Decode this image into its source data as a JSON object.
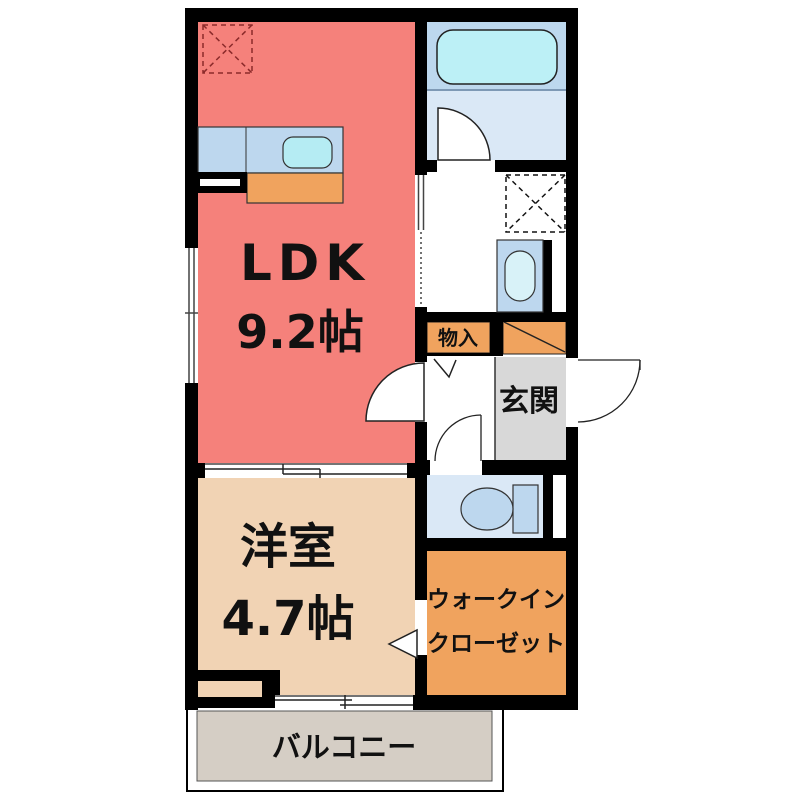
{
  "plan": {
    "type": "apartment-floor-plan",
    "rooms": {
      "ldk": {
        "label": "LDK",
        "size": "9.2帖"
      },
      "western_room": {
        "label": "洋室",
        "size": "4.7帖"
      },
      "entrance": {
        "label": "玄関"
      },
      "storage": {
        "label": "物入"
      },
      "walk_in_closet": {
        "label_line1": "ウォークイン",
        "label_line2": "クローゼット"
      },
      "balcony": {
        "label": "バルコニー"
      }
    },
    "fixtures": {
      "bathtub": "bathtub-icon",
      "toilet": "toilet-icon",
      "kitchen_sink": "kitchen-counter-sink-icon",
      "wash_basin": "wash-basin-icon",
      "washing_machine_space": "washing-machine-dashed-box-icon",
      "refrigerator_space": "refrigerator-dashed-box-icon",
      "shoe_cabinet": "shoe-cabinet-diagonal-icon"
    },
    "colors": {
      "wall": "#000000",
      "ldk": "#F5817B",
      "western": "#F1D3B4",
      "orange": "#F0A35E",
      "entrance_floor": "#D8D8D8",
      "balcony_floor": "#D5CEC5",
      "bath_floor": "#DAE8F6",
      "bath_tub_zone": "#BDD8EE",
      "tub": "#BCF0F6",
      "counter": "#BDD7EE",
      "sink": "#B5ECF3",
      "fixture": "#BDD7EE",
      "basin": "#D8F2F8",
      "alcove_inner": "#F1D3B4",
      "white": "#FFFFFF"
    }
  }
}
